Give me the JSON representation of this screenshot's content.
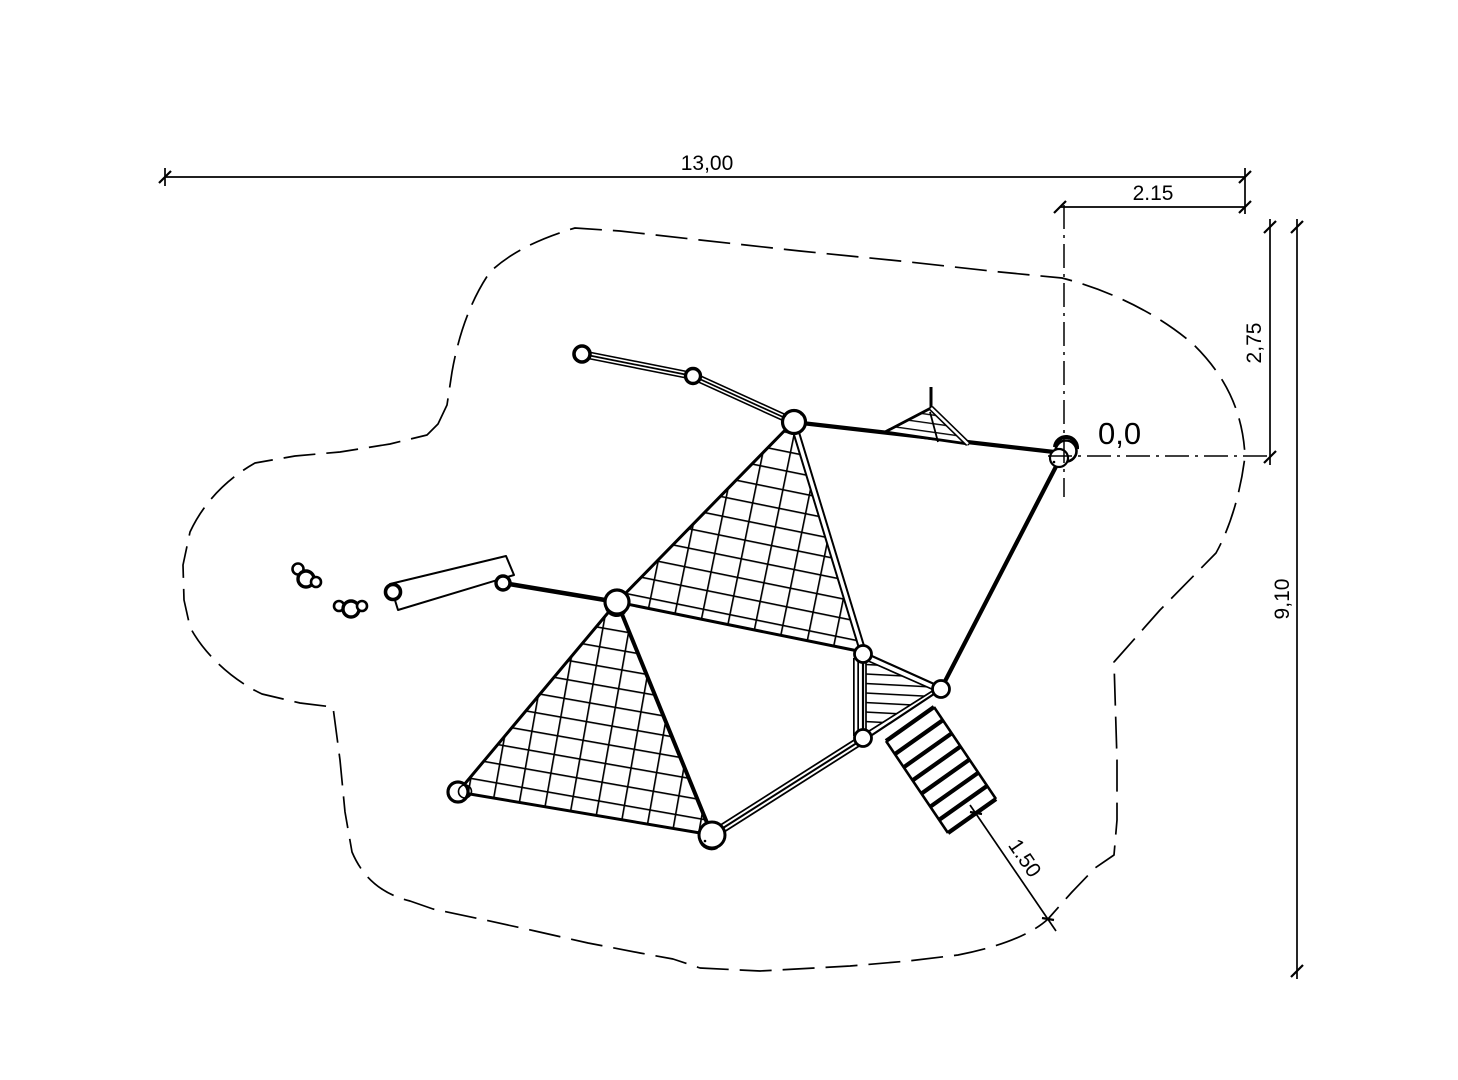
{
  "drawing": {
    "background": "#ffffff",
    "ink": "#000000",
    "labels": {
      "total_width": "13,00",
      "origin_offset_right": "2.15",
      "origin_offset_top": "2,75",
      "total_height": "9,10",
      "ladder_clearance": "1.50",
      "origin_marker": "0,0"
    }
  }
}
